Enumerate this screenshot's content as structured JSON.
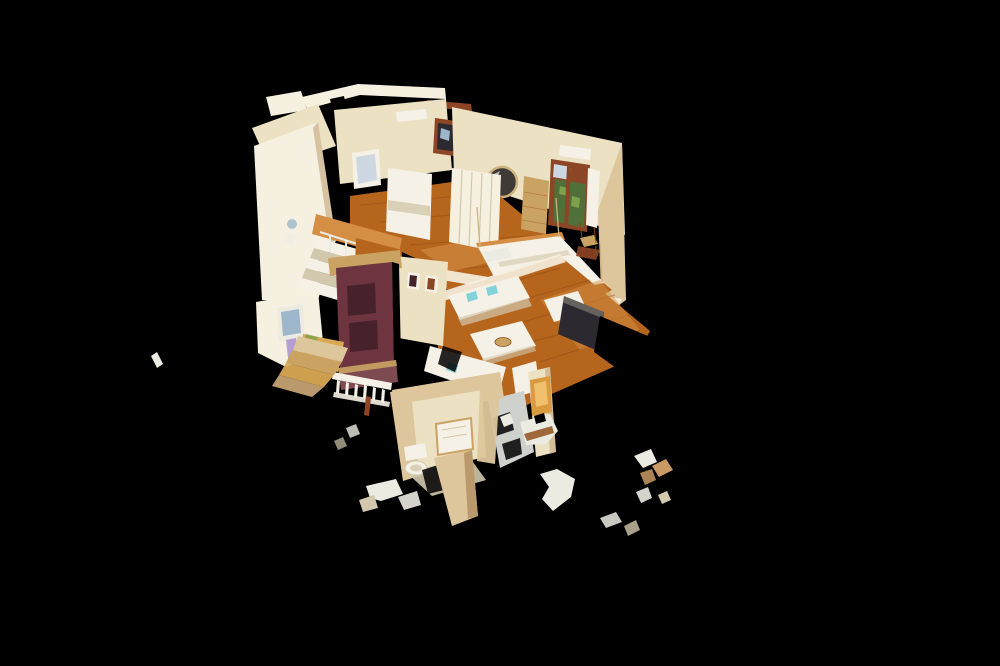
{
  "scene": {
    "description": "Cut-away 3D dollhouse scan of a two-storey villa interior, viewed from above at a tilt, floating on a pure black background with scattered point-cloud fragments",
    "view": "dollhouse-overhead",
    "background": "#000000",
    "floors": [
      {
        "name": "upper-floor",
        "rooms": [
          "stair-tower",
          "bunk-bedroom",
          "master-bedroom"
        ]
      },
      {
        "name": "ground-floor",
        "rooms": [
          "entry-hall",
          "living-room",
          "lower-bathroom"
        ]
      }
    ],
    "notable_items": [
      "white staircase",
      "maroon front door",
      "white sofas with teal cushions",
      "white dining table with bowl",
      "round mirror",
      "french door with garden view",
      "canopy bed",
      "wardrobe",
      "toilet",
      "warm lit doorway",
      "scattered scan fragments"
    ]
  },
  "palette": {
    "bg": "#000000",
    "wallBright": "#f6f0e0",
    "wallCream": "#ece1c4",
    "wallTan": "#dcc69c",
    "wallOchre": "#d8a855",
    "wallShadow": "#b99a6e",
    "woodMain": "#b4651f",
    "woodLight": "#d28f47",
    "woodDark": "#8a4714",
    "woodPale": "#c9a264",
    "doorMaroon": "#6d3540",
    "doorPanel": "#47222b",
    "plum": "#7d4a52",
    "frameRed": "#8a4526",
    "foliage": "#52703a",
    "foliageLight": "#7fa04e",
    "sky": "#cdd8e2",
    "teal": "#85d2d8",
    "linen": "#f5f1e6",
    "stepShade": "#d2c8ae",
    "glowWarm": "#d89a42",
    "glowBright": "#f0c070",
    "darkObject": "#2c2a30",
    "grayFloor": "#cfd2cc",
    "mirrorDark": "#3f3a35",
    "brass": "#cdb382",
    "paleBlue": "#9fb6c8",
    "purple": "#a98fd0",
    "fragWhite": "#ecebe2",
    "fragTan": "#c89a66"
  }
}
